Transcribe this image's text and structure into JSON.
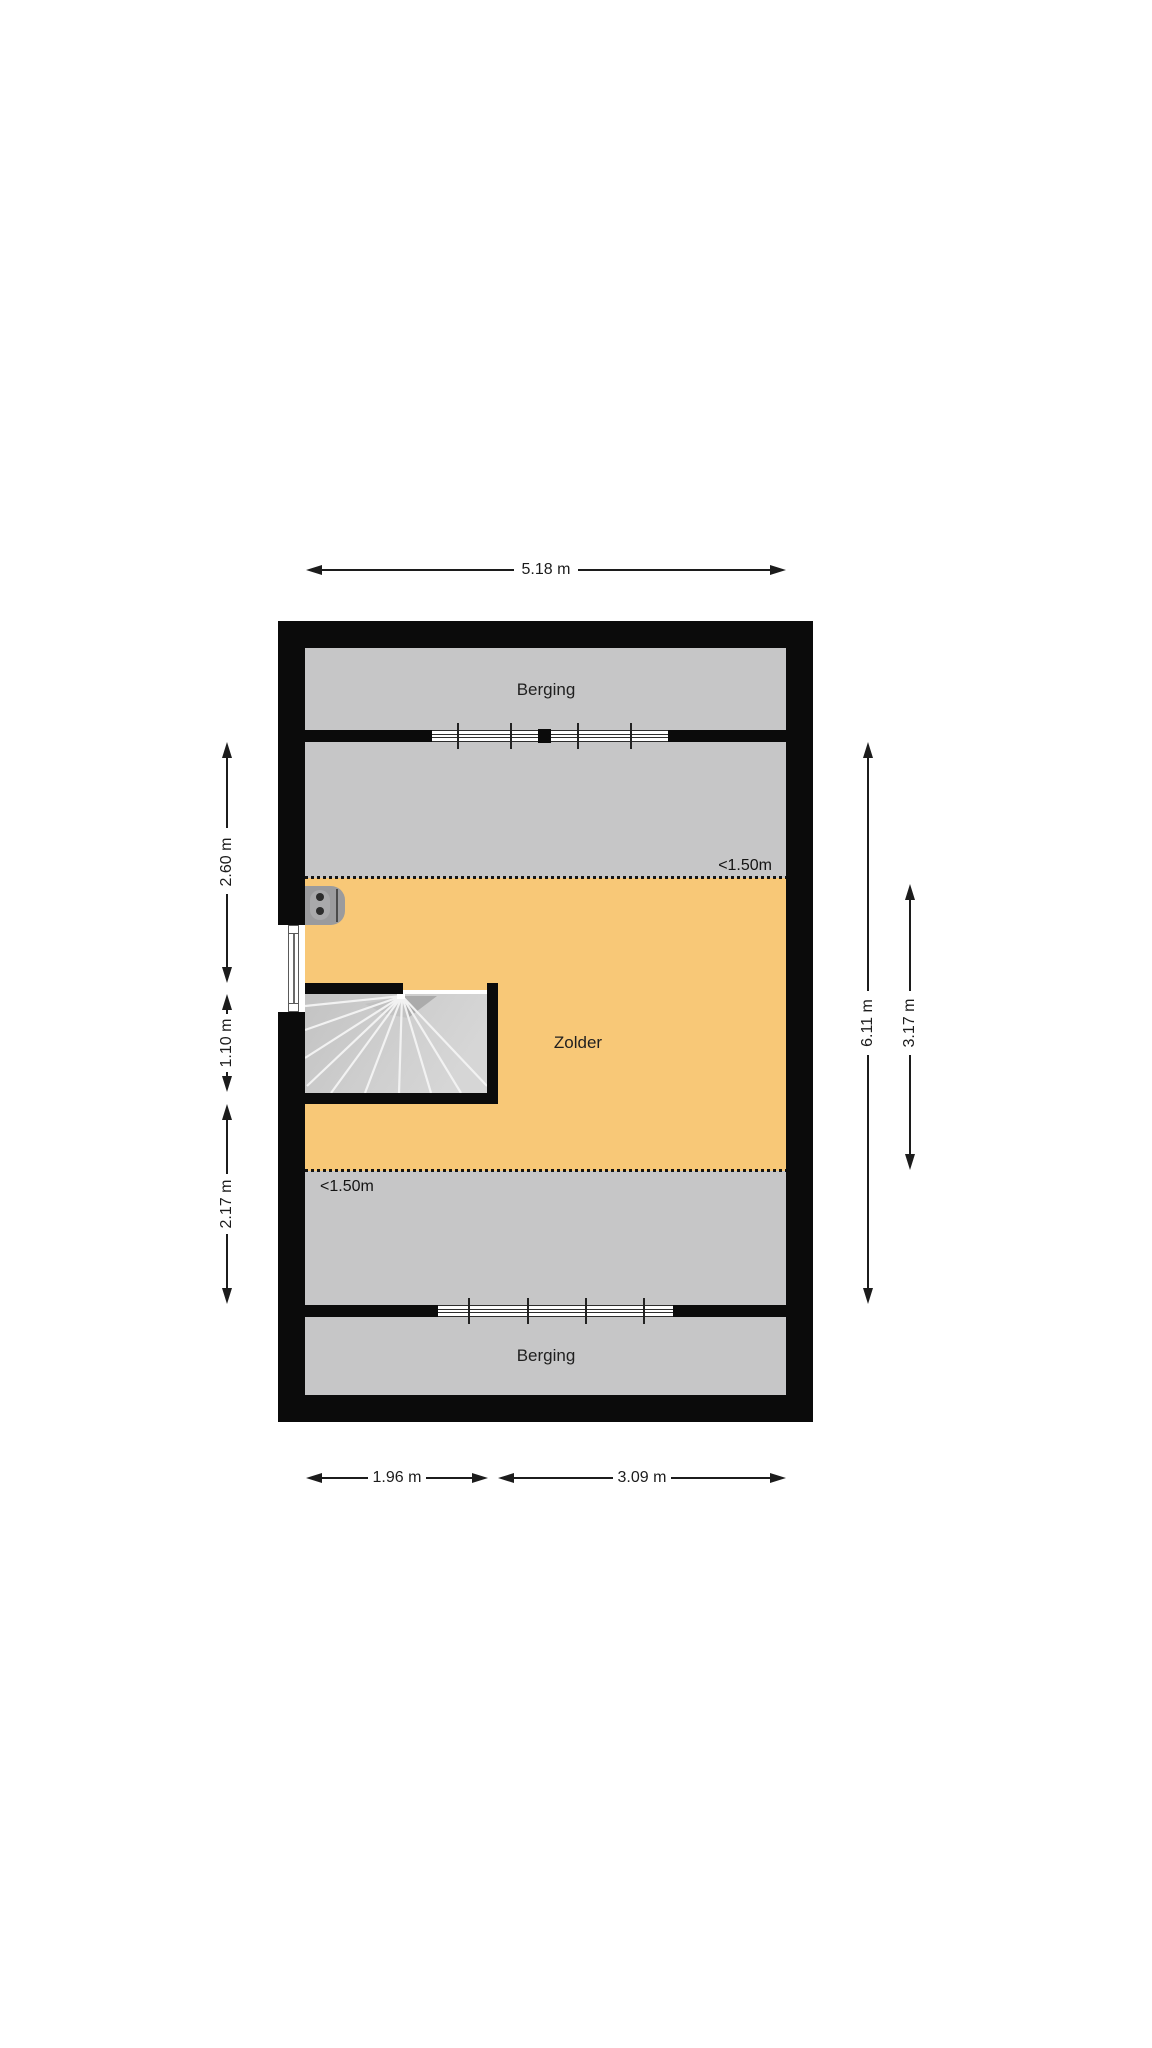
{
  "plan": {
    "type": "floor-plan",
    "rooms": {
      "berging_top": "Berging",
      "zolder": "Zolder",
      "berging_bottom": "Berging"
    },
    "height_markers": {
      "upper": "<1.50m",
      "lower": "<1.50m"
    },
    "dimensions": {
      "top_width": "5.18 m",
      "left_upper": "2.60 m",
      "left_middle": "1.10 m",
      "left_lower": "2.17 m",
      "right_full": "6.11 m",
      "right_inner": "3.17 m",
      "bottom_left": "1.96 m",
      "bottom_right": "3.09 m"
    },
    "colors": {
      "wall": "#0b0b0b",
      "floor_gray": "#c6c6c7",
      "zolder_orange": "#f8c877",
      "stair_gray": "#cccccc",
      "text": "#1c1c1c",
      "background": "#ffffff"
    }
  }
}
